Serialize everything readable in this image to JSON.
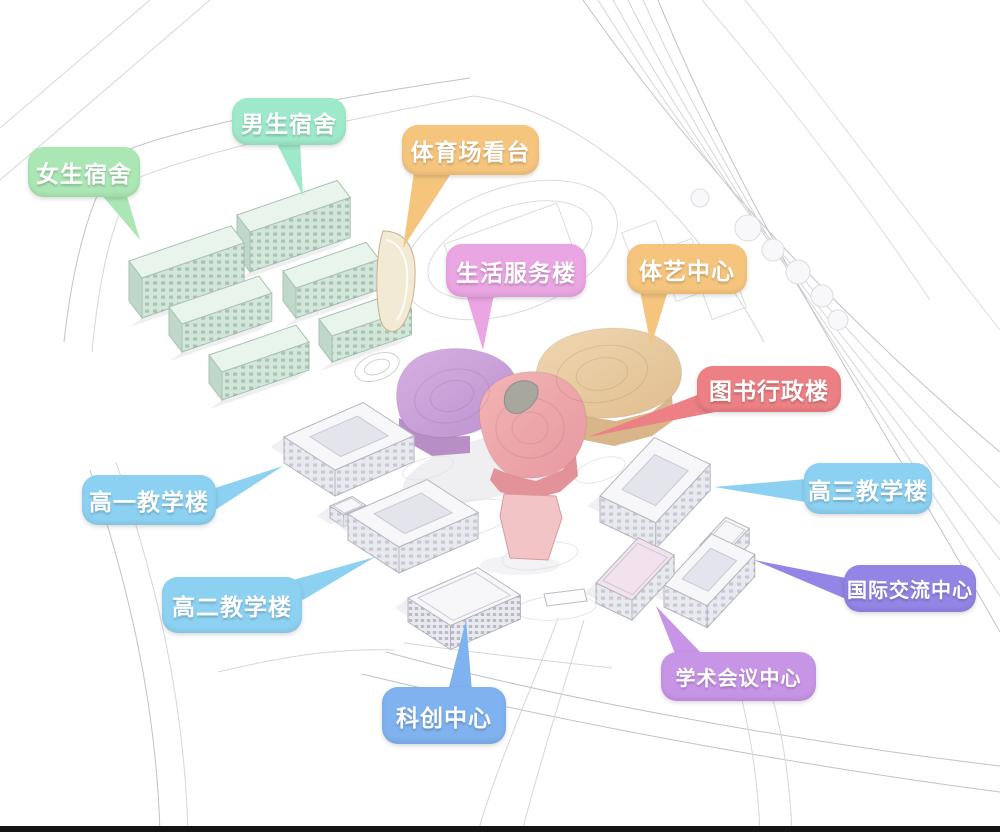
{
  "palette": {
    "background": "#ffffff",
    "road_line": "#d6d6da",
    "road_line_strong": "#c2c2c8",
    "linework": "#dcdce0",
    "shadow": "#e2e2e7",
    "dorm_roof": "#e8f4ec",
    "dorm_front": "#d2e7da",
    "dorm_end": "#bfd8c9",
    "dorm_stroke": "#a8c2b2",
    "white_roof": "#f7f7fa",
    "white_wall": "#e9e9f0",
    "white_stroke": "#b6b6c2",
    "courtyard": "#e4e4ec",
    "conference_roof": "#f2e2ee",
    "stand_fill": "#f3ead6",
    "stand_stroke": "#c9b088",
    "flower_left": "#c79fd6",
    "flower_left_dark": "#b78fc6",
    "flower_right": "#e9cba2",
    "flower_right_dark": "#d9b68a",
    "flower_bottom": "#eda6a9",
    "flower_bottom_dark": "#e4929a",
    "flower_stem": "#f2c4c6",
    "flower_court": "#a7a79f",
    "bottom_bar": "#141414"
  },
  "labels": [
    {
      "id": "girls-dorm",
      "text": "女生宿舍",
      "color": "#abe7b4"
    },
    {
      "id": "boys-dorm",
      "text": "男生宿舍",
      "color": "#9fe9cb"
    },
    {
      "id": "stadium-stands",
      "text": "体育场看台",
      "color": "#f5c57e"
    },
    {
      "id": "life-service-building",
      "text": "生活服务楼",
      "color": "#eaa5e3"
    },
    {
      "id": "sports-arts-center",
      "text": "体艺中心",
      "color": "#f5c57e"
    },
    {
      "id": "library-admin-building",
      "text": "图书行政楼",
      "color": "#ec8084"
    },
    {
      "id": "grade1-teaching",
      "text": "高一教学楼",
      "color": "#8dd1f2"
    },
    {
      "id": "grade3-teaching",
      "text": "高三教学楼",
      "color": "#8dd1f2"
    },
    {
      "id": "grade2-teaching",
      "text": "高二教学楼",
      "color": "#8dd1f2"
    },
    {
      "id": "international-exchange",
      "text": "国际交流中心",
      "color": "#9285e5"
    },
    {
      "id": "sci-innovation-center",
      "text": "科创中心",
      "color": "#7fb2ee"
    },
    {
      "id": "academic-conference",
      "text": "学术会议中心",
      "color": "#c794e6"
    }
  ]
}
